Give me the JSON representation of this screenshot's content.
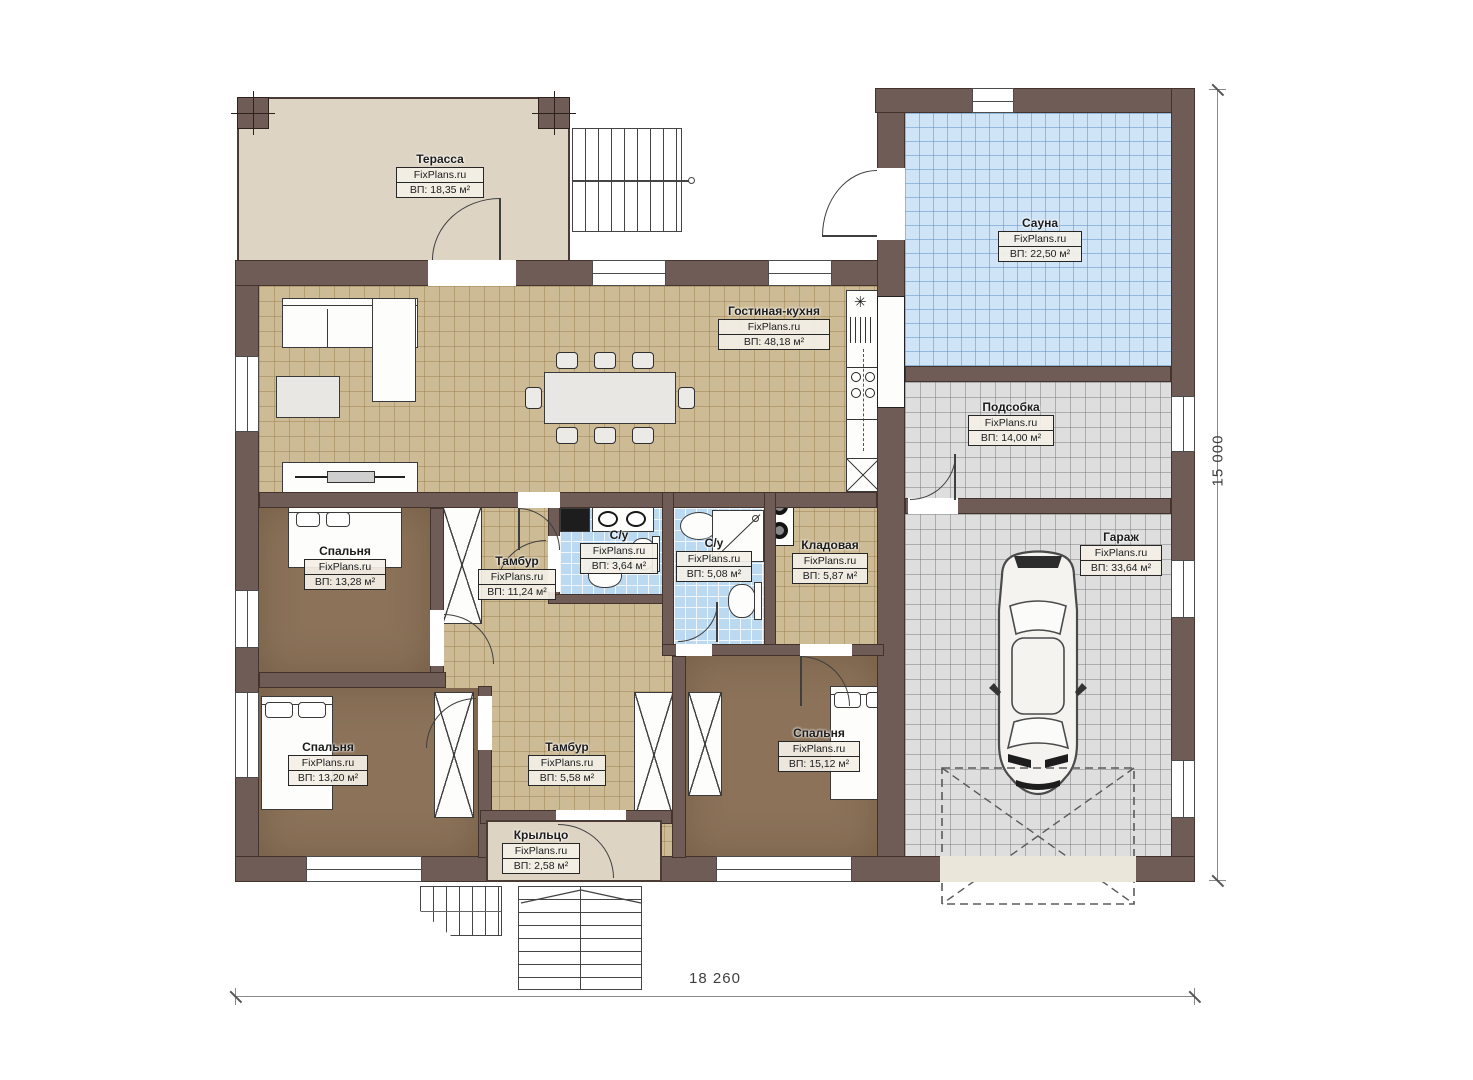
{
  "plan": {
    "brand": "FixPlans.ru",
    "dimensions": {
      "bottom": "18 260",
      "right": "15 000"
    },
    "rooms": [
      {
        "name": "Терасса",
        "area": "ВП: 18,35 м²"
      },
      {
        "name": "Сауна",
        "area": "ВП: 22,50 м²"
      },
      {
        "name": "Гостиная-кухня",
        "area": "ВП: 48,18 м²"
      },
      {
        "name": "Подсобка",
        "area": "ВП: 14,00 м²"
      },
      {
        "name": "Спальня",
        "area": "ВП: 13,28 м²"
      },
      {
        "name": "Тамбур",
        "area": "ВП: 11,24 м²"
      },
      {
        "name": "С/у",
        "area": "ВП: 3,64 м²"
      },
      {
        "name": "С/у",
        "area": "ВП: 5,08 м²"
      },
      {
        "name": "Кладовая",
        "area": "ВП: 5,87 м²"
      },
      {
        "name": "Гараж",
        "area": "ВП: 33,64 м²"
      },
      {
        "name": "Спальня",
        "area": "ВП: 13,20 м²"
      },
      {
        "name": "Тамбур",
        "area": "ВП: 5,58 м²"
      },
      {
        "name": "Спальня",
        "area": "ВП: 15,12 м²"
      },
      {
        "name": "Крыльцо",
        "area": "ВП: 2,58 м²"
      }
    ],
    "colors": {
      "wall": "#6f5c56",
      "terrace": "#ded4c3",
      "living_tile": "#cdbb95",
      "sauna_tile": "#cfe4f6",
      "utility_tile": "#dedede",
      "bedroom_floor": "#8b7259",
      "bath_tile": "#bcd9f2"
    }
  }
}
